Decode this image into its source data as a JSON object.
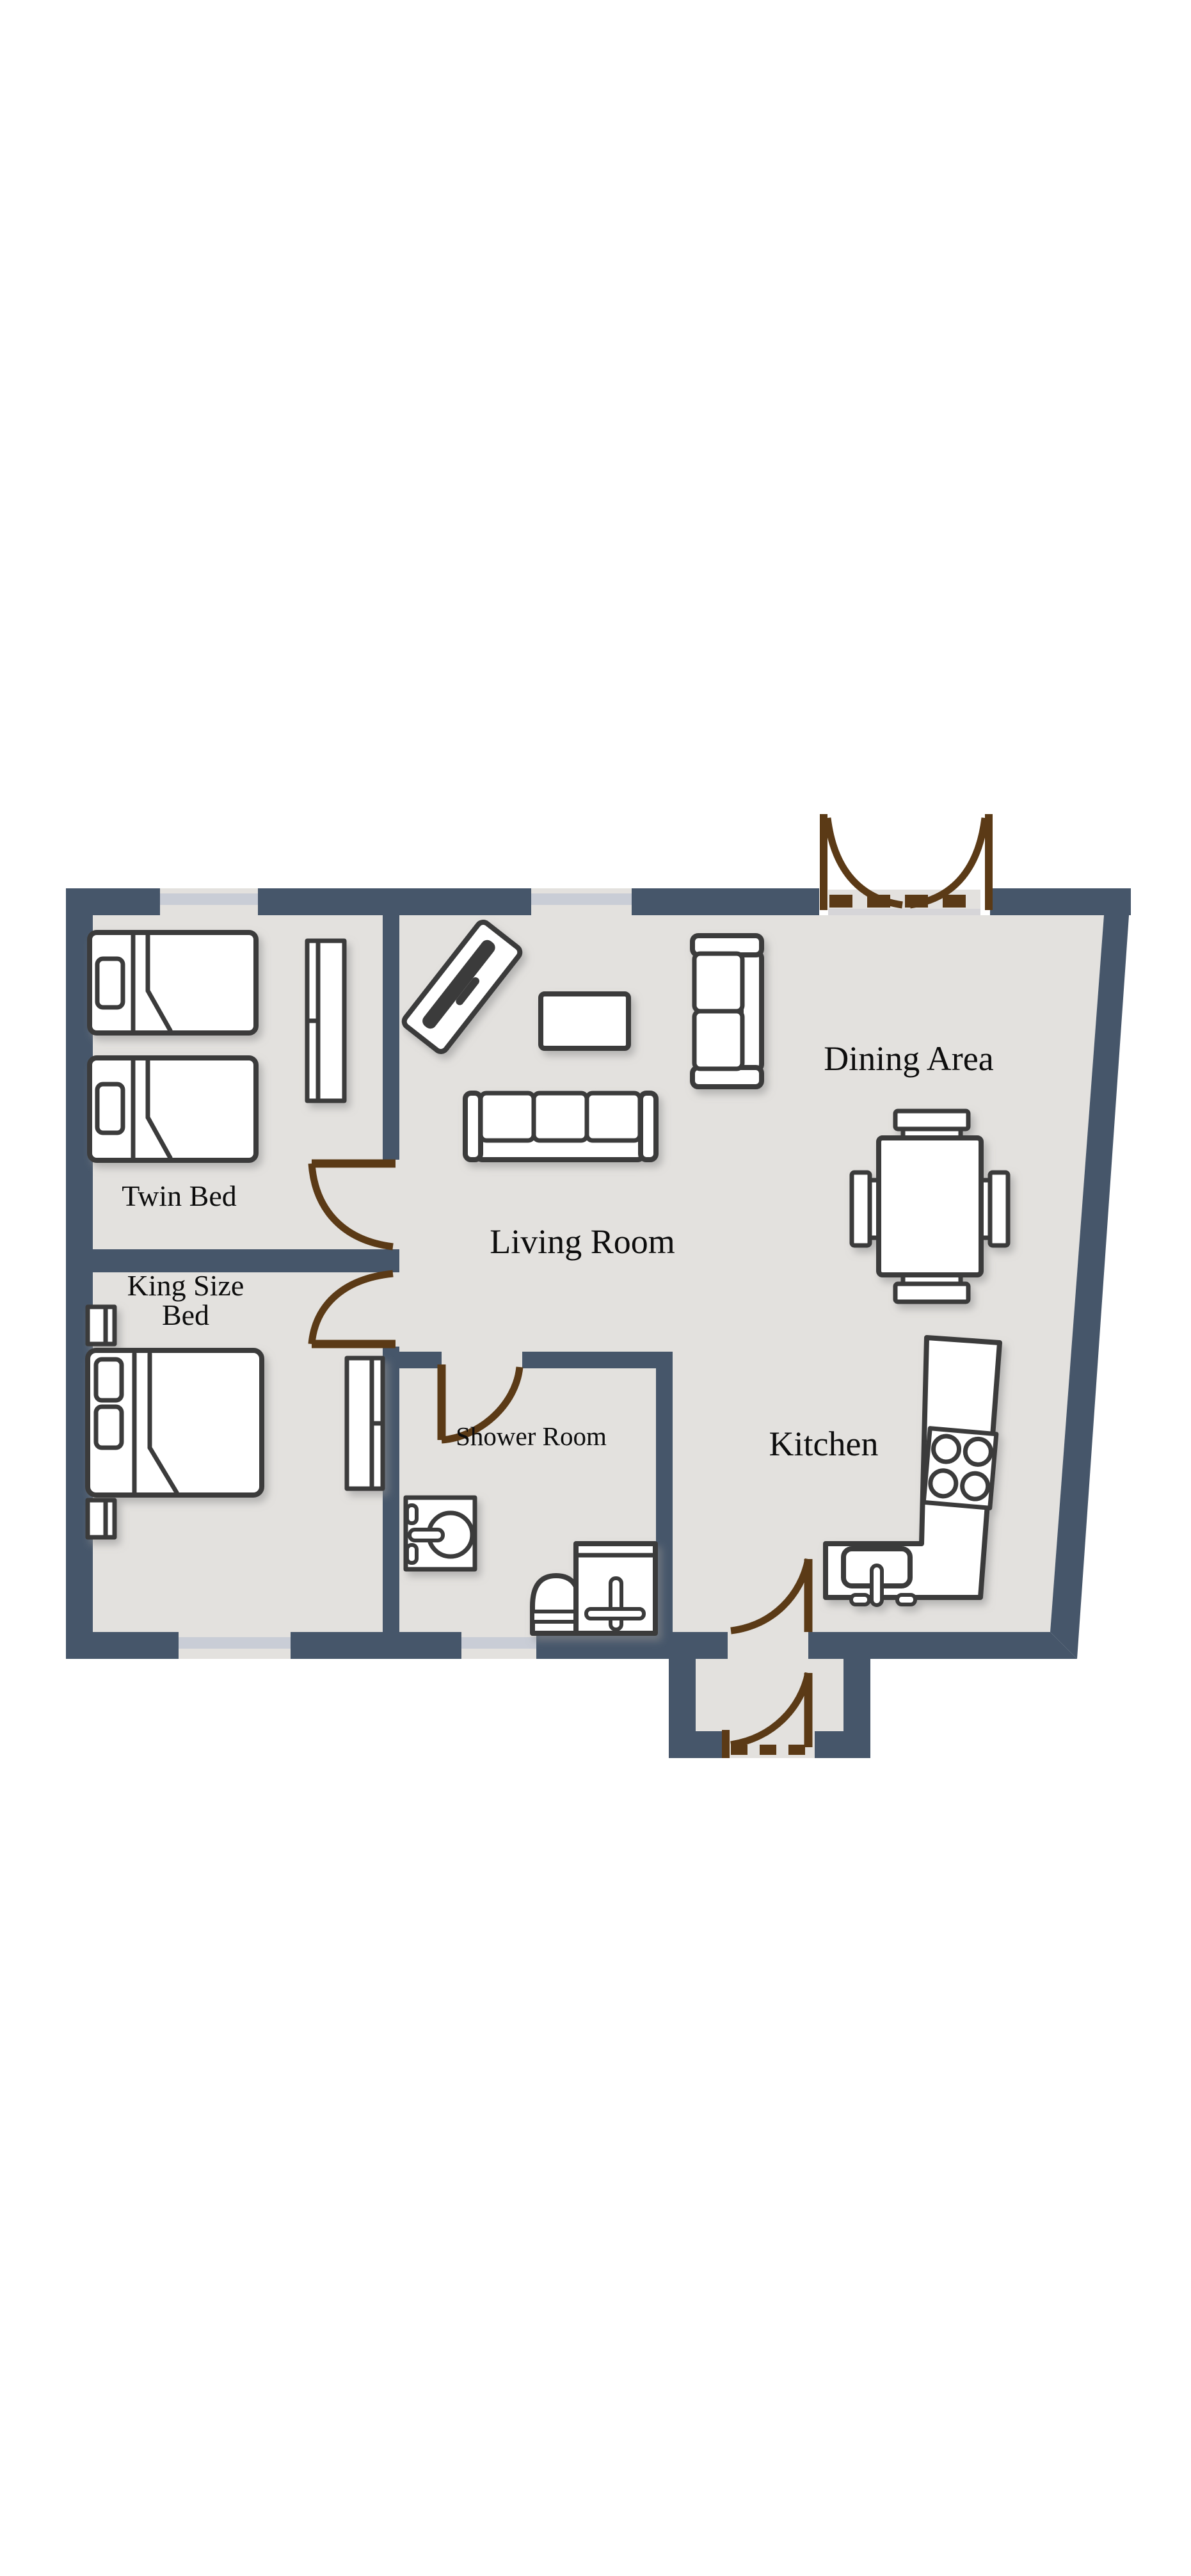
{
  "title": "Apartment floor plan",
  "colors": {
    "background": "#FFFFFF",
    "wall": "#46566A",
    "floor": "#E3E1DE",
    "door": "#5B3A16",
    "window": "#C9CDD6",
    "furniture_outline": "#3B3B3B",
    "label": "#0D0D0D"
  },
  "rooms": {
    "twin": {
      "label": "Twin Bed"
    },
    "king": {
      "label_line1": "King Size",
      "label_line2": "Bed"
    },
    "living": {
      "label": "Living Room"
    },
    "dining": {
      "label": "Dining Area"
    },
    "kitchen": {
      "label": "Kitchen"
    },
    "shower": {
      "label": "Shower Room"
    }
  }
}
